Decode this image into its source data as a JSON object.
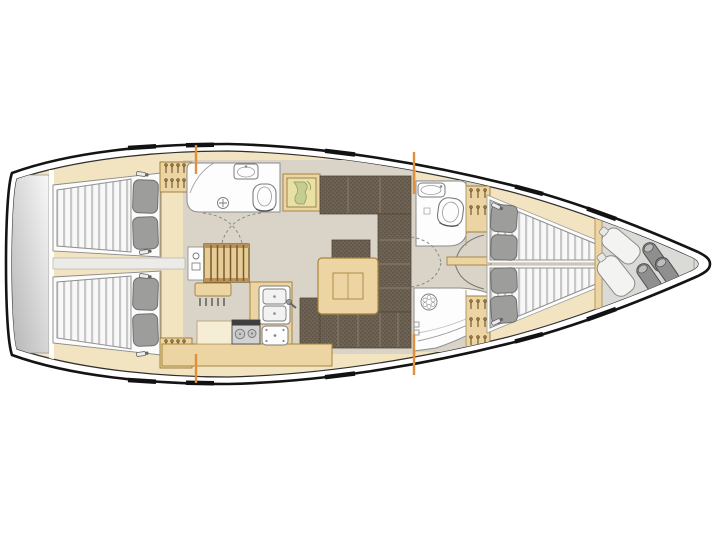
{
  "meta": {
    "title": "Sailing yacht interior floor plan, top view, bow pointing right",
    "orientation": "bow-right",
    "style": "technical brochure deck plan, no text labels"
  },
  "colors": {
    "background": "#ffffff",
    "hull_outline": "#141414",
    "inner_deck_line": "#2e2e2e",
    "interior_wood": "#f2e3c1",
    "cabin_sole": "#d9d4c7",
    "wood_cabinet": "#ecd5a2",
    "wood_trim": "#a8853e",
    "stair_tread": "#e6cc97",
    "stair_rail": "#b8925a",
    "upholstery": "#6e6355",
    "upholstery_dot": "#5c5244",
    "upholstery_seam": "#8d8273",
    "mattress_base": "#f8f8f8",
    "mattress_stripe": "#c7c7c7",
    "bed_platform": "#fcfcfc",
    "pillow": "#9d9d9b",
    "fixture_white": "#fdfdfd",
    "fixture_line": "#7c7c7c",
    "chart_map": "#e9e0a4",
    "chart_land": "#c6cd90",
    "platform_light": "#f8f8f8",
    "platform_dark": "#b5b5b5",
    "locker_floor": "#dadad7",
    "sail_bag": "#f3f3f1",
    "sail_roll": "#8f8f8f",
    "sail_roll_cap": "#bdbdbd",
    "accent_orange": "#e08f3c",
    "engine_box": "#ebebe7",
    "stove_body": "#d2d2d2",
    "stove_band": "#3f3f3f",
    "hatch_black": "#121212",
    "worktop": "#f6edd6"
  },
  "areas": [
    {
      "id": "swim-platform",
      "label": "Stern transom / swim platform"
    },
    {
      "id": "aft-cabin-port",
      "label": "Aft double cabin, port side"
    },
    {
      "id": "aft-cabin-starboard",
      "label": "Aft double cabin, starboard side"
    },
    {
      "id": "aft-head",
      "label": "Aft head with shower, washbasin and toilet"
    },
    {
      "id": "companionway",
      "label": "Companionway steps from cockpit"
    },
    {
      "id": "chart-table",
      "label": "Navigation chart table with sea chart"
    },
    {
      "id": "saloon",
      "label": "Saloon with L-settees and folding table"
    },
    {
      "id": "galley",
      "label": "L-shaped galley with twin sinks, stove and fridge"
    },
    {
      "id": "forward-head",
      "label": "Forward head with toilet and washbasin"
    },
    {
      "id": "forward-shower",
      "label": "Forward shower room"
    },
    {
      "id": "forward-cabin",
      "label": "Forward cabin with two tapered berths"
    },
    {
      "id": "sail-locker",
      "label": "Bow sail locker with sail bags and rolled sails"
    }
  ],
  "fixtures": {
    "double_berths": 4,
    "pillows": 8,
    "wet_rooms": 3,
    "toilets": 2,
    "bathroom_sinks": 2,
    "galley_sinks": 2,
    "stove_burners": 2,
    "companionway_steps": 6,
    "hanging_lockers": 4,
    "sail_rolls": 3,
    "sail_bags": 2,
    "deck_hatch_marks": 8,
    "chainplate_marks": 4
  }
}
